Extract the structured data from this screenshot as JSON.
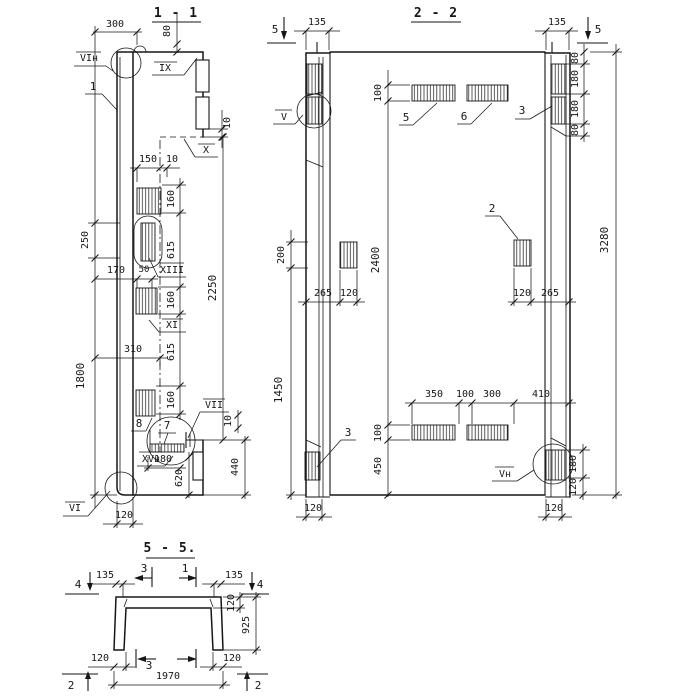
{
  "s11": {
    "title": "1 - 1",
    "p": {
      "n1": "1",
      "n7": "7",
      "n8": "8"
    },
    "m": {
      "viN": "VIн",
      "ix": "IX",
      "x": "X",
      "xiii": "XIII",
      "xi": "XI",
      "vii": "VII",
      "xvN": "XVн",
      "vi": "VI"
    },
    "d": {
      "w300": "300",
      "h80": "80",
      "h10t": "10",
      "w150": "150",
      "w10": "10",
      "v250": "250",
      "v1800": "1800",
      "w170": "170",
      "w50": "50",
      "w310": "310",
      "c160a": "160",
      "c615a": "615",
      "c160b": "160",
      "c615b": "615",
      "c160c": "160",
      "v2250": "2250",
      "w180": "180",
      "v620": "620",
      "v440": "440",
      "v10": "10",
      "w120": "120"
    }
  },
  "s22": {
    "title": "2 - 2",
    "p": {
      "n2": "2",
      "n3a": "3",
      "n3b": "3",
      "n5": "5",
      "n6": "6"
    },
    "m": {
      "v": "V",
      "vN": "Vн",
      "cut5L": "5",
      "cut5R": "5"
    },
    "d": {
      "w135L": "135",
      "w135R": "135",
      "r80a": "80",
      "r180a": "180",
      "r180b": "180",
      "r80b": "80",
      "v3280": "3280",
      "v200": "200",
      "v1450": "1450",
      "c100a": "100",
      "c2400": "2400",
      "c100b": "100",
      "c450": "450",
      "w265L": "265",
      "w120L": "120",
      "w120R": "120",
      "w265R": "265",
      "w350": "350",
      "w100": "100",
      "w300": "300",
      "w410": "410",
      "r180c": "180",
      "r120c": "120",
      "b120L": "120",
      "b120R": "120"
    }
  },
  "s55": {
    "title": "5 - 5.",
    "m": {
      "cut4L": "4",
      "cut4R": "4",
      "cut3T": "3",
      "cut1T": "1",
      "cut3B": "3",
      "cut2L": "2",
      "cut2R": "2"
    },
    "d": {
      "w135L": "135",
      "w135R": "135",
      "v120": "120",
      "v925": "925",
      "b120L": "120",
      "b120R": "120",
      "w1970": "1970"
    }
  }
}
